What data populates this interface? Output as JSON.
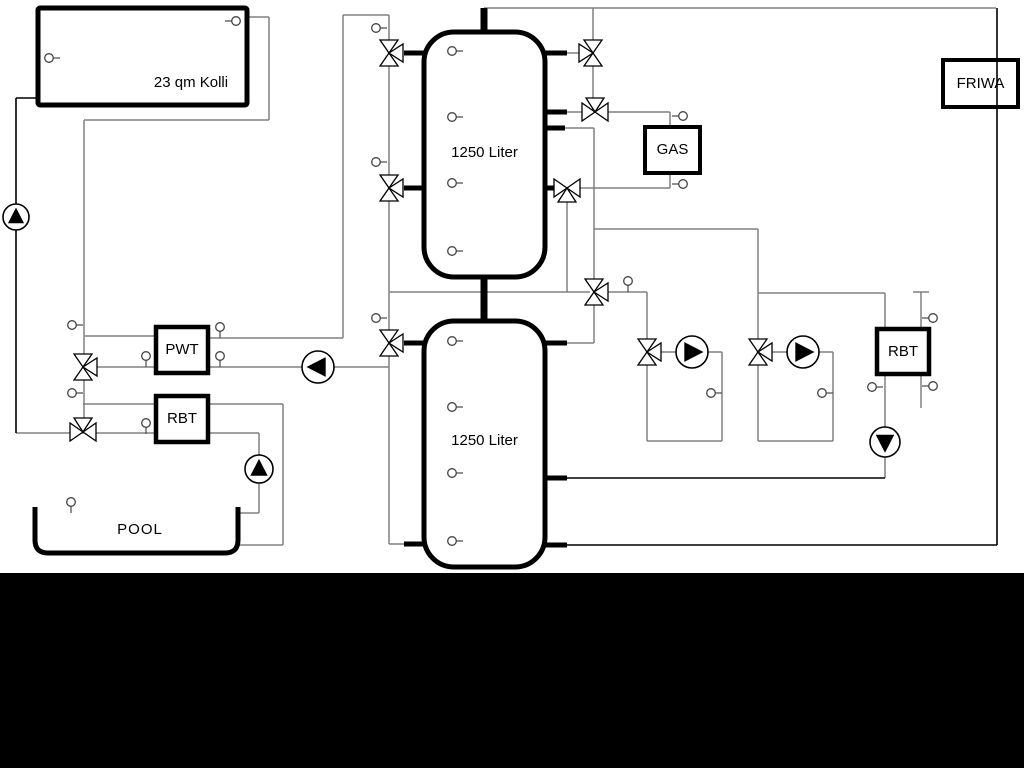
{
  "labels": {
    "collector": "23 qm Kolli",
    "tank_top": "1250 Liter",
    "tank_bottom": "1250 Liter",
    "gas": "GAS",
    "friwa": "FRIWA",
    "pwt": "PWT",
    "rbt_left": "RBT",
    "rbt_right": "RBT",
    "pool": "POOL"
  },
  "colors": {
    "pipe_gray": "#808080",
    "pipe_black": "#000000",
    "symbol_stroke": "#000000",
    "background": "#ffffff",
    "footer_bar": "#000000"
  },
  "diagram": {
    "width": 1024,
    "height": 768,
    "pipes": [
      [
        484,
        8,
        996,
        8,
        1.5,
        "g"
      ],
      [
        343,
        15,
        389,
        15,
        1.5,
        "g"
      ],
      [
        343,
        15,
        343,
        338,
        1.5,
        "g"
      ],
      [
        208,
        338,
        343,
        338,
        1.5,
        "g"
      ],
      [
        84,
        120,
        269,
        120,
        1.5,
        "g"
      ],
      [
        269,
        17,
        269,
        120,
        1.5,
        "g"
      ],
      [
        247,
        17,
        269,
        17,
        1.5,
        "g"
      ],
      [
        84,
        120,
        84,
        432,
        1.5,
        "g"
      ],
      [
        84,
        336,
        156,
        336,
        1.5,
        "g"
      ],
      [
        88,
        367,
        156,
        367,
        1.5,
        "g"
      ],
      [
        83,
        404,
        156,
        404,
        1.5,
        "g"
      ],
      [
        208,
        404,
        283,
        404,
        1.5,
        "g"
      ],
      [
        283,
        404,
        283,
        545,
        1.5,
        "g"
      ],
      [
        240,
        545,
        283,
        545,
        1.5,
        "g"
      ],
      [
        16,
        433,
        156,
        433,
        1.5,
        "g"
      ],
      [
        208,
        433,
        259,
        433,
        1.5,
        "g"
      ],
      [
        259,
        433,
        259,
        513,
        1.5,
        "g"
      ],
      [
        240,
        513,
        259,
        513,
        1.5,
        "g"
      ],
      [
        389,
        15,
        389,
        544,
        1.5,
        "g"
      ],
      [
        389,
        544,
        406,
        544,
        1.5,
        "g"
      ],
      [
        208,
        367,
        389,
        367,
        1.5,
        "g"
      ],
      [
        389,
        292,
        590,
        292,
        1.5,
        "g"
      ],
      [
        567,
        53,
        583,
        53,
        1.5,
        "g"
      ],
      [
        593,
        8,
        593,
        112,
        1.5,
        "g"
      ],
      [
        567,
        112,
        583,
        112,
        1.5,
        "g"
      ],
      [
        607,
        112,
        670,
        112,
        1.5,
        "g"
      ],
      [
        670,
        112,
        670,
        127,
        1.5,
        "g"
      ],
      [
        565,
        128,
        594,
        128,
        1.5,
        "g"
      ],
      [
        594,
        128,
        594,
        343,
        1.5,
        "g"
      ],
      [
        580,
        188,
        670,
        188,
        1.5,
        "g"
      ],
      [
        670,
        173,
        670,
        188,
        1.5,
        "g"
      ],
      [
        567,
        196,
        567,
        292,
        1.5,
        "g"
      ],
      [
        594,
        229,
        758,
        229,
        1.5,
        "g"
      ],
      [
        758,
        229,
        758,
        441,
        1.5,
        "g"
      ],
      [
        758,
        293,
        885,
        293,
        1.5,
        "g"
      ],
      [
        885,
        293,
        885,
        478,
        1.5,
        "g"
      ],
      [
        608,
        292,
        647,
        292,
        1.5,
        "g"
      ],
      [
        647,
        292,
        647,
        441,
        1.5,
        "g"
      ],
      [
        659,
        352,
        677,
        352,
        1.5,
        "g"
      ],
      [
        707,
        352,
        722,
        352,
        1.5,
        "g"
      ],
      [
        722,
        352,
        722,
        441,
        1.5,
        "g"
      ],
      [
        647,
        441,
        722,
        441,
        1.5,
        "g"
      ],
      [
        770,
        352,
        788,
        352,
        1.5,
        "g"
      ],
      [
        818,
        352,
        833,
        352,
        1.5,
        "g"
      ],
      [
        833,
        352,
        833,
        441,
        1.5,
        "g"
      ],
      [
        758,
        441,
        833,
        441,
        1.5,
        "g"
      ],
      [
        921,
        292,
        921,
        408,
        1.5,
        "g"
      ],
      [
        913,
        292,
        929,
        292,
        1.5,
        "g"
      ],
      [
        567,
        343,
        594,
        343,
        1.5,
        "g"
      ],
      [
        997,
        8,
        997,
        545,
        1.6,
        "k"
      ],
      [
        567,
        545,
        997,
        545,
        1.6,
        "k"
      ],
      [
        16,
        98,
        16,
        433,
        1.6,
        "k"
      ],
      [
        16,
        98,
        38,
        98,
        1.6,
        "k"
      ],
      [
        567,
        478,
        885,
        478,
        1.6,
        "k"
      ],
      [
        484,
        8,
        484,
        36,
        7,
        "k"
      ],
      [
        484,
        274,
        484,
        324,
        7,
        "k"
      ],
      [
        404,
        53,
        426,
        53,
        5,
        "k"
      ],
      [
        404,
        188,
        426,
        188,
        5,
        "k"
      ],
      [
        404,
        343,
        426,
        343,
        5,
        "k"
      ],
      [
        404,
        544,
        426,
        544,
        5,
        "k"
      ],
      [
        544,
        53,
        567,
        53,
        5,
        "k"
      ],
      [
        544,
        112,
        567,
        112,
        5,
        "k"
      ],
      [
        544,
        128,
        565,
        128,
        5,
        "k"
      ],
      [
        544,
        188,
        558,
        188,
        5,
        "k"
      ],
      [
        544,
        343,
        567,
        343,
        5,
        "k"
      ],
      [
        544,
        478,
        567,
        478,
        5,
        "k"
      ],
      [
        544,
        545,
        567,
        545,
        5,
        "k"
      ]
    ],
    "vessels": [
      {
        "name": "collector-box",
        "x": 38,
        "y": 8,
        "w": 209,
        "h": 97,
        "stroke": 5,
        "rx": 2,
        "fill": "#ffffff"
      },
      {
        "name": "tank-top",
        "x": 424,
        "y": 32,
        "w": 121,
        "h": 245,
        "stroke": 5,
        "rx": 30,
        "fill": "#ffffff"
      },
      {
        "name": "tank-bottom",
        "x": 424,
        "y": 321,
        "w": 121,
        "h": 246,
        "stroke": 5,
        "rx": 30,
        "fill": "#ffffff"
      },
      {
        "name": "gas-boiler-box",
        "x": 645,
        "y": 127,
        "w": 55,
        "h": 46,
        "stroke": 4,
        "rx": 0,
        "fill": "#ffffff"
      },
      {
        "name": "friwa-box",
        "x": 943,
        "y": 60,
        "w": 75,
        "h": 47,
        "stroke": 4,
        "rx": 0,
        "fill": "none"
      },
      {
        "name": "pwt-box",
        "x": 156,
        "y": 327,
        "w": 52,
        "h": 46,
        "stroke": 4.5,
        "rx": 0,
        "fill": "#ffffff"
      },
      {
        "name": "rbt-left-box",
        "x": 156,
        "y": 396,
        "w": 52,
        "h": 46,
        "stroke": 4.5,
        "rx": 0,
        "fill": "#ffffff"
      },
      {
        "name": "rbt-right-box",
        "x": 877,
        "y": 329,
        "w": 52,
        "h": 45,
        "stroke": 4.5,
        "rx": 0,
        "fill": "#ffffff"
      }
    ],
    "pool": {
      "x": 35,
      "y": 507,
      "w": 203,
      "h": 46,
      "stroke": 5,
      "corner": 13
    },
    "valves": [
      {
        "x": 389,
        "y": 53,
        "main": "v",
        "branch": "right"
      },
      {
        "x": 389,
        "y": 188,
        "main": "v",
        "branch": "right"
      },
      {
        "x": 389,
        "y": 343,
        "main": "v",
        "branch": "right"
      },
      {
        "x": 83,
        "y": 367,
        "main": "v",
        "branch": "right"
      },
      {
        "x": 83,
        "y": 432,
        "main": "h",
        "branch": "top"
      },
      {
        "x": 593,
        "y": 53,
        "main": "v",
        "branch": "left"
      },
      {
        "x": 595,
        "y": 112,
        "main": "h",
        "branch": "top"
      },
      {
        "x": 567,
        "y": 188,
        "main": "h",
        "branch": "bottom"
      },
      {
        "x": 594,
        "y": 292,
        "main": "v",
        "branch": "right"
      },
      {
        "x": 647,
        "y": 352,
        "main": "v",
        "branch": "right"
      },
      {
        "x": 758,
        "y": 352,
        "main": "v",
        "branch": "right"
      }
    ],
    "pumps": [
      {
        "x": 16,
        "y": 217,
        "dir": "up",
        "r": 13
      },
      {
        "x": 318,
        "y": 367,
        "dir": "left",
        "r": 16
      },
      {
        "x": 259,
        "y": 469,
        "dir": "up",
        "r": 14
      },
      {
        "x": 692,
        "y": 352,
        "dir": "right",
        "r": 16
      },
      {
        "x": 803,
        "y": 352,
        "dir": "right",
        "r": 16
      },
      {
        "x": 885,
        "y": 442,
        "dir": "down",
        "r": 15
      }
    ],
    "sensors": [
      {
        "x": 49,
        "y": 58,
        "stem": "right"
      },
      {
        "x": 236,
        "y": 21,
        "stem": "left"
      },
      {
        "x": 72,
        "y": 325,
        "stem": "right"
      },
      {
        "x": 72,
        "y": 393,
        "stem": "right"
      },
      {
        "x": 71,
        "y": 502,
        "stem": "down"
      },
      {
        "x": 146,
        "y": 356,
        "stem": "down"
      },
      {
        "x": 220,
        "y": 327,
        "stem": "down"
      },
      {
        "x": 220,
        "y": 356,
        "stem": "down"
      },
      {
        "x": 146,
        "y": 423,
        "stem": "down"
      },
      {
        "x": 376,
        "y": 28,
        "stem": "right"
      },
      {
        "x": 376,
        "y": 162,
        "stem": "right"
      },
      {
        "x": 376,
        "y": 318,
        "stem": "right"
      },
      {
        "x": 452,
        "y": 51,
        "stem": "right"
      },
      {
        "x": 452,
        "y": 117,
        "stem": "right"
      },
      {
        "x": 452,
        "y": 183,
        "stem": "right"
      },
      {
        "x": 452,
        "y": 251,
        "stem": "right"
      },
      {
        "x": 452,
        "y": 341,
        "stem": "right"
      },
      {
        "x": 452,
        "y": 407,
        "stem": "right"
      },
      {
        "x": 452,
        "y": 473,
        "stem": "right"
      },
      {
        "x": 452,
        "y": 541,
        "stem": "right"
      },
      {
        "x": 683,
        "y": 116,
        "stem": "left"
      },
      {
        "x": 683,
        "y": 184,
        "stem": "left"
      },
      {
        "x": 628,
        "y": 281,
        "stem": "down"
      },
      {
        "x": 711,
        "y": 393,
        "stem": "right"
      },
      {
        "x": 822,
        "y": 393,
        "stem": "right"
      },
      {
        "x": 872,
        "y": 387,
        "stem": "right"
      },
      {
        "x": 933,
        "y": 318,
        "stem": "left"
      },
      {
        "x": 933,
        "y": 386,
        "stem": "left"
      }
    ],
    "footer_bar": {
      "x": 0,
      "y": 573,
      "w": 1024,
      "h": 195
    }
  }
}
